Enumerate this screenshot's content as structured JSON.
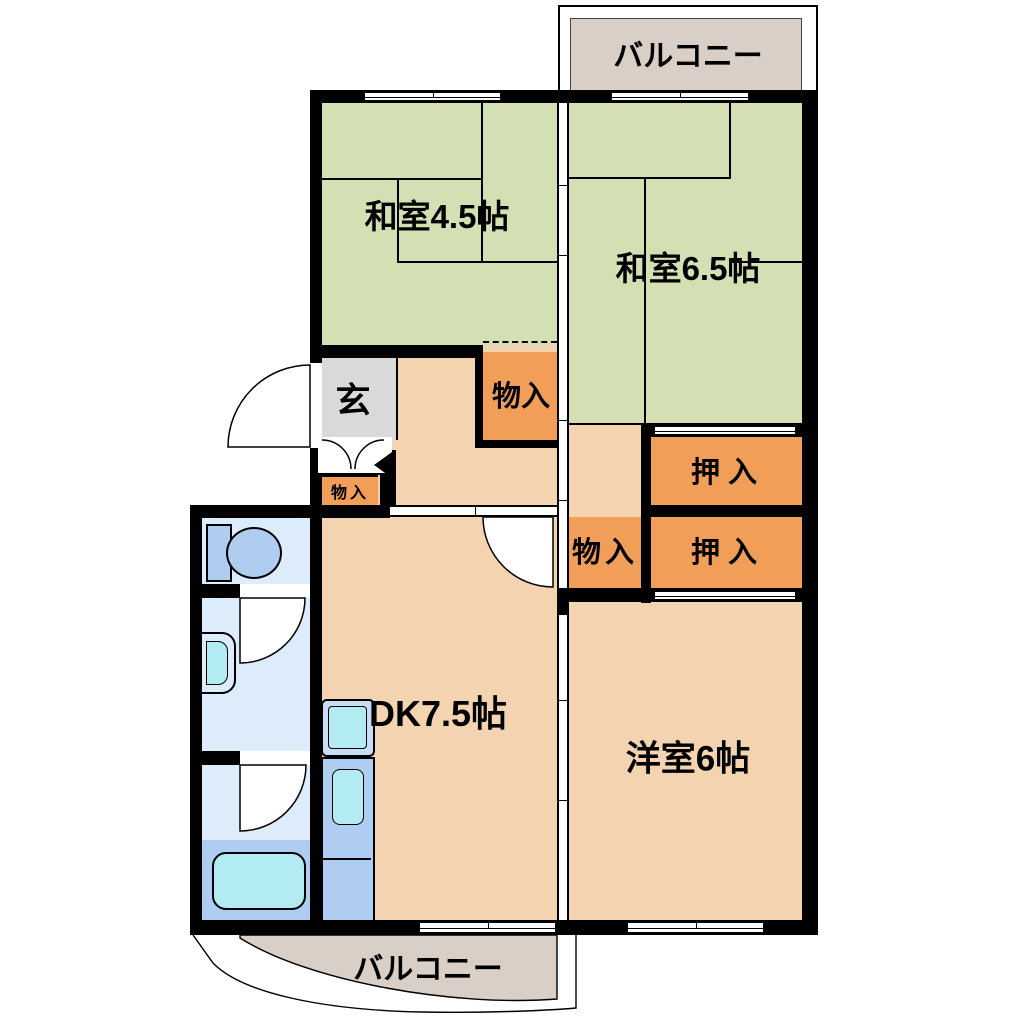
{
  "plan": {
    "type": "floor-plan",
    "labels": {
      "balcony_top": "バルコニー",
      "balcony_bottom": "バルコニー",
      "washitsu_45": "和室4.5帖",
      "washitsu_65": "和室6.5帖",
      "genkan": "玄",
      "storage_hall": "物入",
      "storage_genkan": "物入",
      "storage_mid": "物入",
      "closet_upper": "押入",
      "closet_lower": "押入",
      "dk": "DK7.5帖",
      "western_room": "洋室6帖"
    },
    "colors": {
      "wall_black": "#000000",
      "tatami_green": "#d5dfb4",
      "closet_orange": "#f09e58",
      "room_peach": "#f3d3b0",
      "genkan_gray": "#d9d9d9",
      "balcony_beige": "#d9cfc7",
      "water_room_lightblue": "#dcecfa",
      "water_medium_blue": "#aecdf0",
      "fixture_cyan": "#b2ebf2",
      "background_white": "#ffffff"
    }
  }
}
